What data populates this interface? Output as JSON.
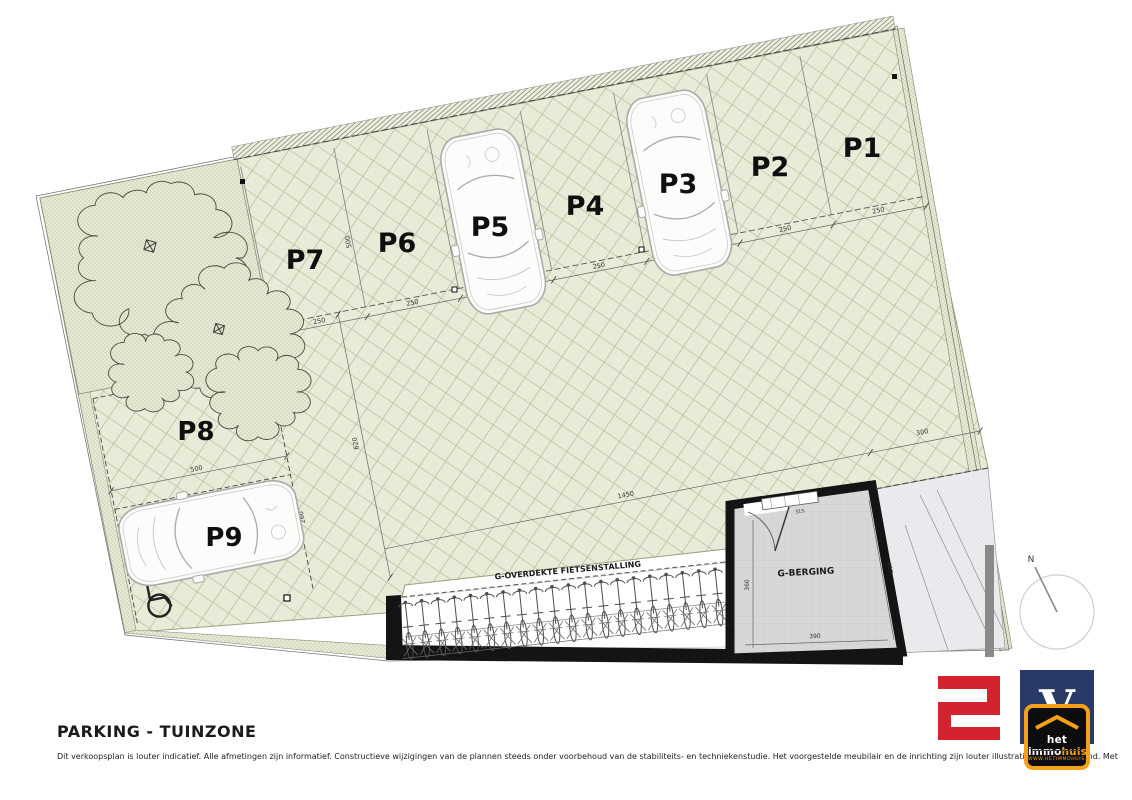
{
  "title": "PARKING - TUINZONE",
  "disclaimer": {
    "part1": "Dit verkoopsplan is louter indicatief. Alle afmetingen zijn informatief. Constructieve wijzigingen van de plannen steeds onder voorbehoud van de stabiliteits- en techniekenstudie. Het voorgestelde meubilair en de inrichting zijn louter illustratief en niet bindend. Met betrekking tot de architectuur wordt verwezen naar de uitvoeringspla",
    "part2": "t."
  },
  "plan": {
    "stalls": [
      "P1",
      "P2",
      "P3",
      "P4",
      "P5",
      "P6",
      "P7",
      "P8",
      "P9"
    ],
    "bike_shelter_label": "G-OVERDEKTE FIETSENSTALLING",
    "storage_label": "G-BERGING",
    "north_label": "N",
    "bike_count": 20,
    "dims": {
      "stall_width": "250",
      "stall_depth": "500",
      "aisle_depth": "620",
      "aisle_length": "1450",
      "right_width": "300",
      "p8_length": "500",
      "p8_width": "250",
      "p9_width": "260",
      "storage_left": "360",
      "storage_bottom": "390",
      "storage_right": "417",
      "storage_window": "315"
    }
  },
  "logos": {
    "immo": {
      "letter": "V",
      "name_part1": "het immo",
      "name_part2": "huis",
      "url": "www.hetimmohuis.be"
    }
  },
  "colors": {
    "green": "#e9ebd8",
    "accent_red": "#d2232e",
    "navy": "#293a66",
    "orange": "#f6a01a"
  }
}
